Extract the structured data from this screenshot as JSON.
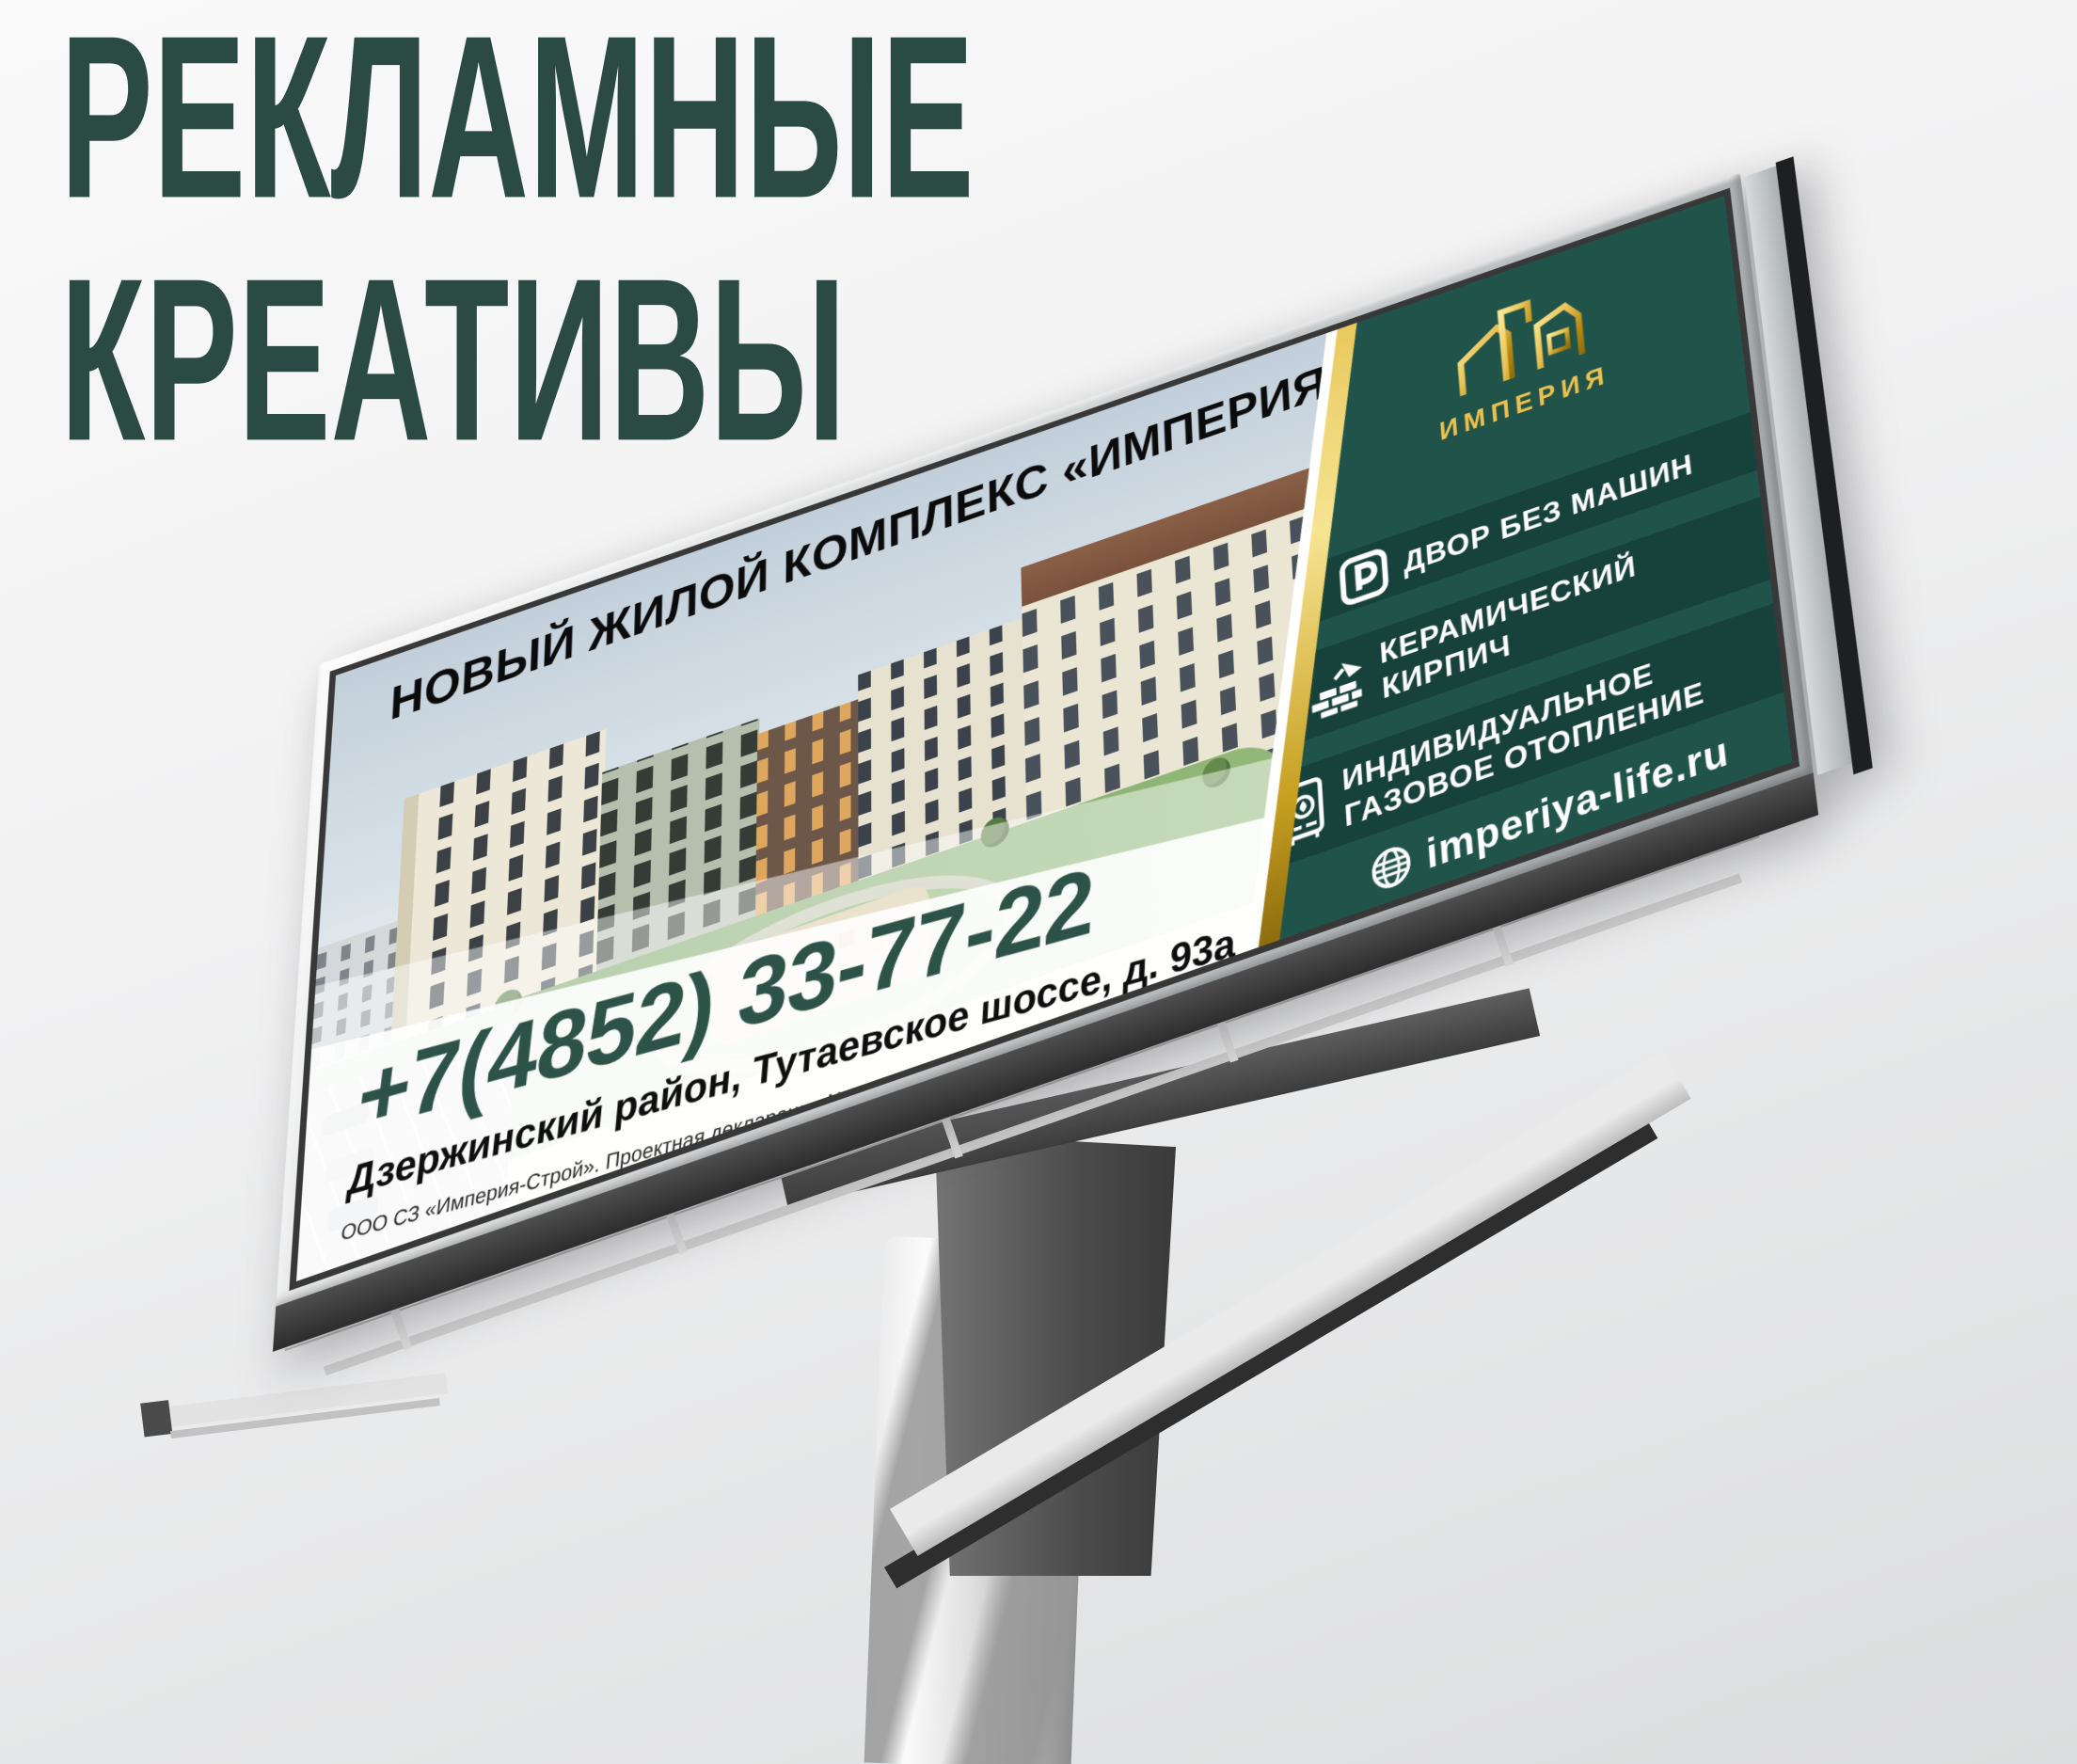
{
  "page": {
    "title_line1": "РЕКЛАМНЫЕ",
    "title_line2": "КРЕАТИВЫ"
  },
  "colors": {
    "title_green": "#2b4a44",
    "panel_green": "#20544a",
    "panel_stripe": "#17423b",
    "gold_accent": "#d9a62a",
    "phone_green": "#2d5349"
  },
  "billboard": {
    "headline": "НОВЫЙ ЖИЛОЙ КОМПЛЕКС «ИМПЕРИЯ»",
    "brand": {
      "name": "ИМПЕРИЯ",
      "icon": "gold-buildings-icon"
    },
    "features": [
      {
        "icon": "parking-icon",
        "line1": "ДВОР БЕЗ МАШИН",
        "line2": ""
      },
      {
        "icon": "brick-trowel-icon",
        "line1": "КЕРАМИЧЕСКИЙ",
        "line2": "КИРПИЧ"
      },
      {
        "icon": "gas-boiler-icon",
        "line1": "ИНДИВИДУАЛЬНОЕ",
        "line2": "ГАЗОВОЕ ОТОПЛЕНИЕ"
      }
    ],
    "website": {
      "icon": "globe-icon",
      "url": "imperiya-life.ru"
    },
    "contact": {
      "phone": "+7(4852) 33-77-22",
      "address": "Дзержинский район, Тутаевское шоссе, д. 93а",
      "legal": "ООО СЗ «Империя-Строй». Проектная декларация №76-000693 на сайте наш.дом.рф"
    }
  }
}
